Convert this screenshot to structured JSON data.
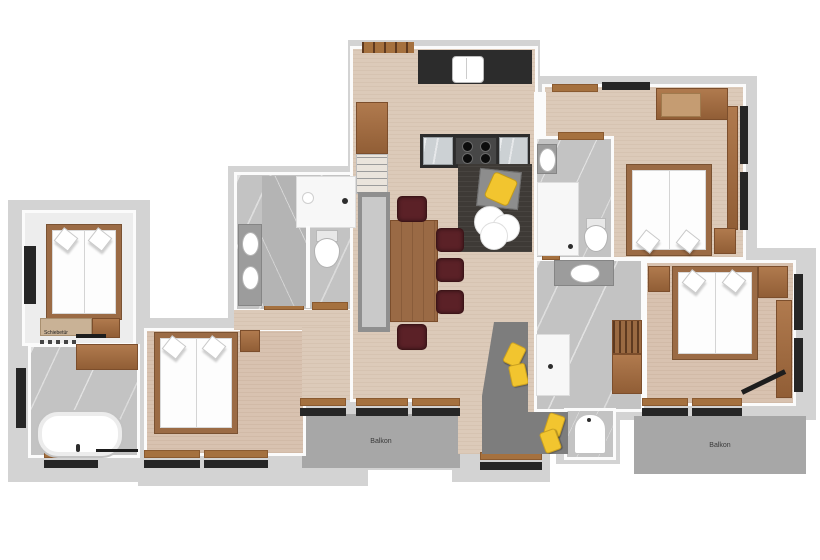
{
  "plan": {
    "labels": {
      "sliding_door": "Schiebetür",
      "balcony_center": "Balkon",
      "balcony_right": "Balkon"
    },
    "palette": {
      "exterior_wall": "#d3d3d3",
      "interior_wall": "#fbfbfb",
      "wood_floor": "#dccab9",
      "wood_furniture": "#a0714a",
      "marble_floor": "#c3c3c3",
      "window_frame": "#262626",
      "kitchen_counter": "#2c2c2c",
      "lounge_floor": "#3e3a36",
      "accent_yellow": "#f2c52f",
      "dining_chair_maroon": "#5b2127",
      "sofa_gray": "#7d7d7d",
      "balcony_gray": "#a7a7a7",
      "fixture_white": "#ffffff"
    },
    "fixtures": [
      "double-bed",
      "bathtub",
      "shower",
      "toilet",
      "washbasin",
      "kitchen-sink",
      "stove",
      "dining-table",
      "dining-chair",
      "corner-sofa",
      "armchair",
      "coffee-table",
      "rug",
      "wardrobe",
      "sideboard",
      "nightstand",
      "balcony"
    ]
  }
}
